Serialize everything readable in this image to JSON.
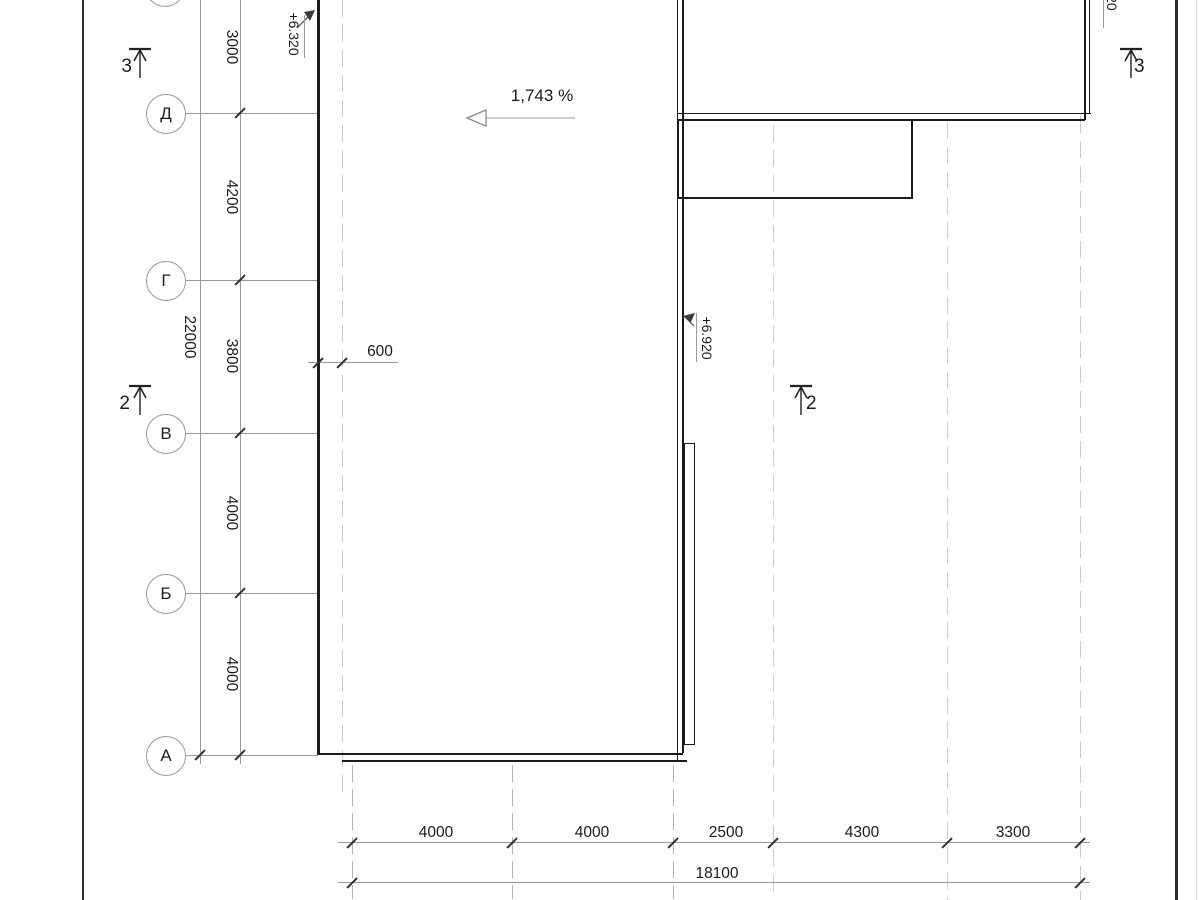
{
  "plan": {
    "slope": {
      "label": "1,743 %"
    },
    "elevations": {
      "left": "+6.320",
      "right": "+6.920",
      "top_fragment": "020"
    },
    "axes": {
      "rows": [
        {
          "label": "Д"
        },
        {
          "label": "Г"
        },
        {
          "label": "В"
        },
        {
          "label": "Б"
        },
        {
          "label": "А"
        }
      ],
      "row_dims": {
        "segments": [
          "3000",
          "4200",
          "3800",
          "4000",
          "4000"
        ],
        "total": "22000"
      },
      "overhang": "600"
    },
    "bottom_dims": {
      "segments": [
        "4000",
        "4000",
        "2500",
        "4300",
        "3300"
      ],
      "total": "18100"
    },
    "sections": {
      "left_top": "3",
      "right_top": "3",
      "left_mid": "2",
      "center": "2"
    },
    "colors": {
      "contour_dark": "#1b1b1b",
      "construction_gray": "#9a9a9a",
      "axis_dash_light": "#cbcbcb"
    }
  }
}
